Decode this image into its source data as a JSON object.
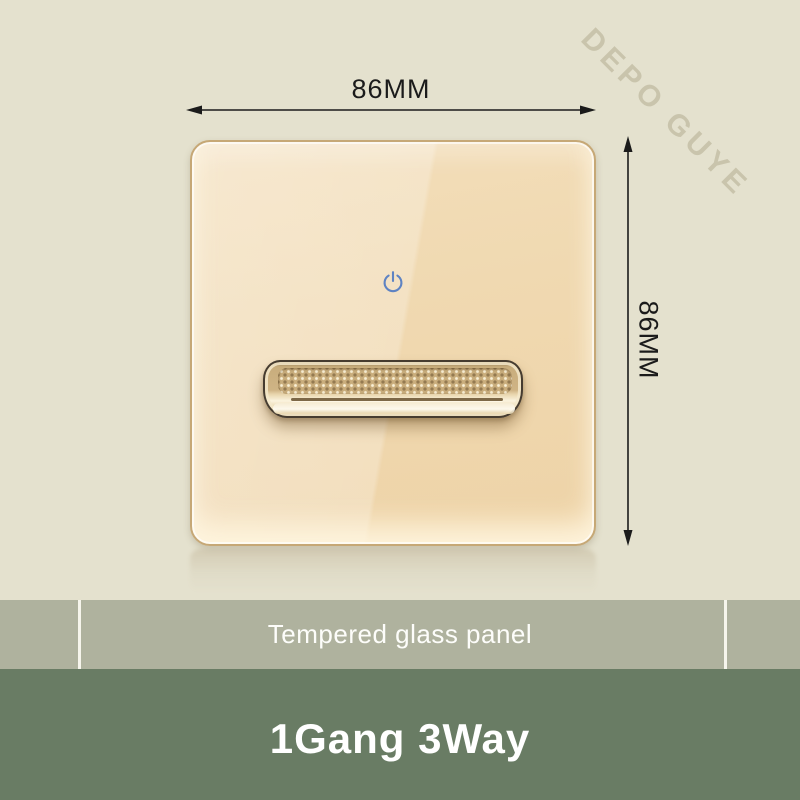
{
  "image": {
    "watermark": "DEPO GUYE",
    "background_color": "#e4e1ce"
  },
  "dimensions": {
    "width_label": "86MM",
    "height_label": "86MM",
    "arrow_color": "#1b1b1b"
  },
  "switch_panel": {
    "icon": "power-icon",
    "power_icon_color": "#5e83c3",
    "glass_color_light": "#f3deba",
    "glass_color_dark": "#eed3a7",
    "frame_color": "#c6a876",
    "rocker_color": "#cfb485"
  },
  "caption_bar": {
    "label": "Tempered glass panel",
    "background": "#afb29e",
    "text_color": "#fdfdfa"
  },
  "title_bar": {
    "label": "1Gang 3Way",
    "background": "#697c64",
    "text_color": "#ffffff"
  }
}
